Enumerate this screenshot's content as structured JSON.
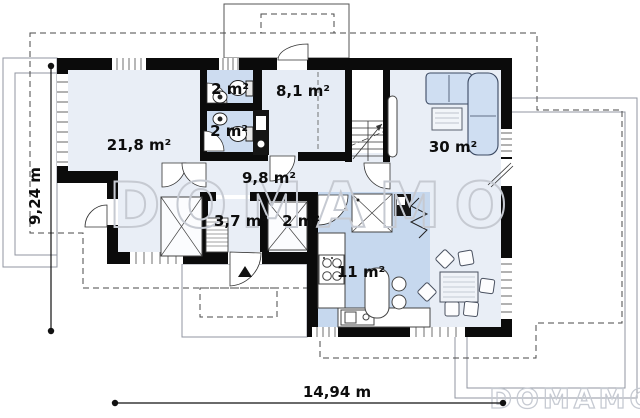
{
  "floorplan": {
    "rooms": [
      {
        "name": "living-room",
        "area": "21,8 m²"
      },
      {
        "name": "wc-upper",
        "area": "2 m²"
      },
      {
        "name": "bathroom-lower",
        "area": "2 m²"
      },
      {
        "name": "upper-hall",
        "area": "8,1 m²"
      },
      {
        "name": "lounge",
        "area": "30 m²"
      },
      {
        "name": "hallway",
        "area": "9,8 m²"
      },
      {
        "name": "utility",
        "area": "3,7 m²"
      },
      {
        "name": "wardrobe",
        "area": "2 m²"
      },
      {
        "name": "kitchen",
        "area": "11 m²"
      }
    ],
    "dimensions": {
      "left": "9,24 m",
      "bottom": "14,94 m"
    },
    "watermark": {
      "center": "DOMAMO",
      "corner": "DOMAMO"
    },
    "colors": {
      "walls": "#0b0b0b",
      "room_light": "#e9eef6",
      "room_wet": "#cddcf0",
      "kitchen_zone": "#c6d8ee",
      "sofa": "#cfdef2",
      "roof_dashes": "#4a4a4a",
      "terrace_outline": "#9096a0",
      "watermark": "#c6cad2"
    }
  }
}
